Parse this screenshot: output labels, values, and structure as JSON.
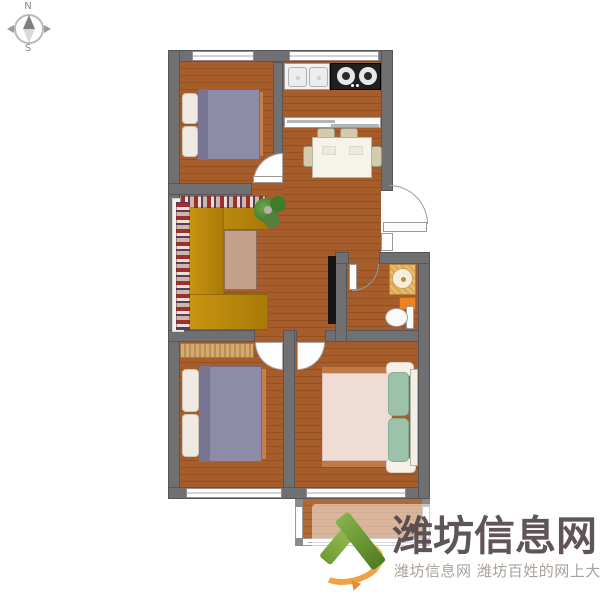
{
  "compass": {
    "north": "N",
    "south": "S"
  },
  "watermark": {
    "brand": "潍坊信息网",
    "tagline": "潍坊信息网 潍坊百姓的网上大集",
    "logo": "v-check-logo-icon"
  },
  "rooms": [
    {
      "name": "bedroom-top-left",
      "furniture": [
        "double-bed-purple",
        "window-top"
      ]
    },
    {
      "name": "kitchen",
      "furniture": [
        "double-basin-sink",
        "two-burner-stove",
        "window-top",
        "pass-through-window"
      ]
    },
    {
      "name": "dining-area",
      "furniture": [
        "dining-table",
        "four-chairs"
      ]
    },
    {
      "name": "living-room",
      "furniture": [
        "u-shaped-sofa",
        "coffee-table",
        "potted-plant",
        "tv"
      ]
    },
    {
      "name": "bathroom",
      "furniture": [
        "washbasin",
        "washing-machine",
        "toilet",
        "door"
      ]
    },
    {
      "name": "bedroom-bottom-left",
      "furniture": [
        "wardrobe",
        "double-bed-purple",
        "window-bottom"
      ]
    },
    {
      "name": "bedroom-bottom-right",
      "furniture": [
        "double-bed-pink-green",
        "window-bottom"
      ]
    },
    {
      "name": "balcony",
      "furniture": [
        "glazed-frame"
      ]
    }
  ],
  "colors": {
    "wall": "#707072",
    "wood_floor": "#a65c2b",
    "wood_floor_dark": "#94501f",
    "sofa": "#c99511",
    "coffee_table": "#c3a28d",
    "bed_blanket_purple": "#8d8ba8",
    "bed_blanket_pink": "#efdcd5",
    "pillow_green": "#9cc2ab",
    "bathroom_accent_orange": "#ef8220",
    "washbasin_tan": "#e0a94e",
    "stove_black": "#1f1f1f",
    "logo_green": "#6f9c31",
    "logo_orange": "#f0a243",
    "watermark_text": "#51464b",
    "watermark_subtext": "#a9a29b"
  }
}
